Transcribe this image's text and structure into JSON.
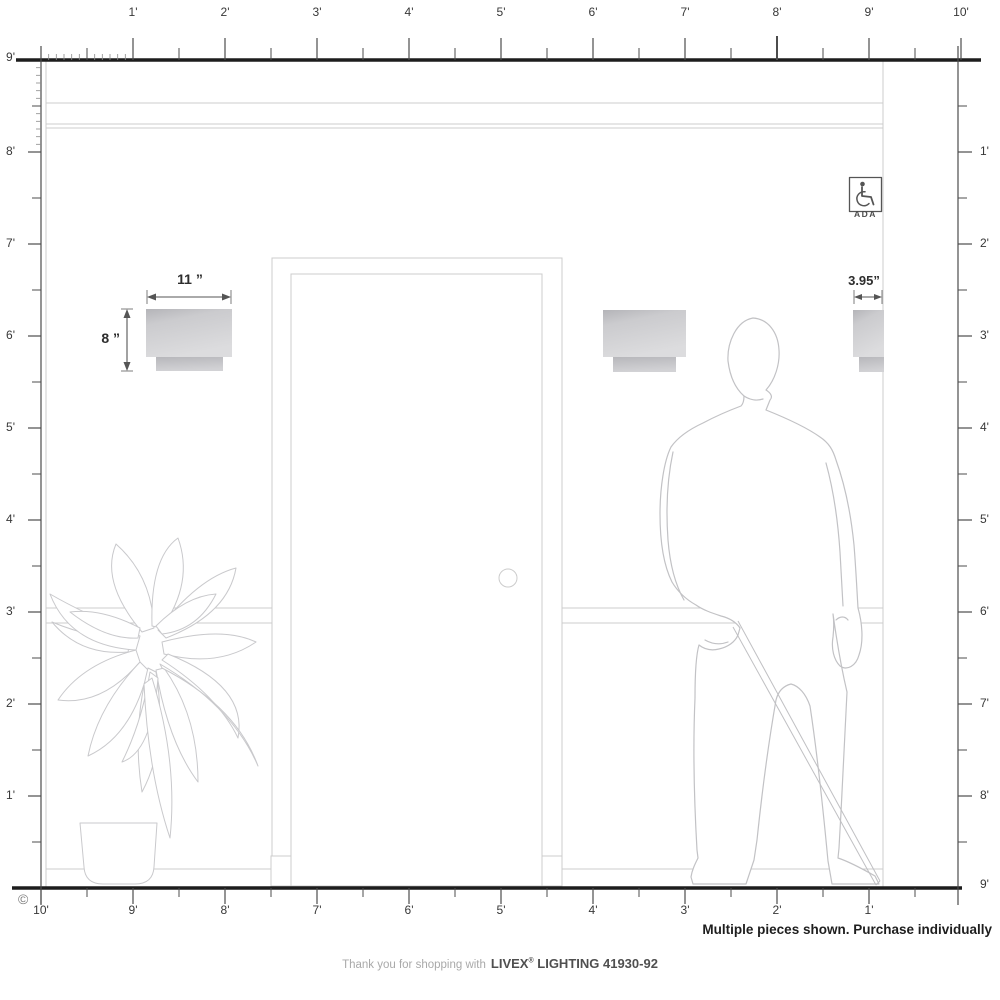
{
  "rulers": {
    "top": [
      "1'",
      "2'",
      "3'",
      "4'",
      "5'",
      "6'",
      "7'",
      "8'",
      "9'",
      "10'"
    ],
    "left": [
      "9'",
      "8'",
      "7'",
      "6'",
      "5'",
      "4'",
      "3'",
      "2'",
      "1'"
    ],
    "right": [
      "1'",
      "2'",
      "3'",
      "4'",
      "5'",
      "6'",
      "7'",
      "8'",
      "9'"
    ],
    "bottom": [
      "10'",
      "9'",
      "8'",
      "7'",
      "6'",
      "5'",
      "4'",
      "3'",
      "2'",
      "1'"
    ]
  },
  "dimensions": {
    "width_label": "11 ”",
    "height_label": "8 ”",
    "depth_label": "3.95”"
  },
  "ada": {
    "label": "ADA"
  },
  "notes": {
    "purchase": "Multiple pieces shown. Purchase individually",
    "copyright": "©"
  },
  "footer": {
    "prefix": "Thank you for shopping with",
    "brand": "LIVEX",
    "registered": "®",
    "rest": " LIGHTING 41930-92"
  },
  "colors": {
    "ruler": "#4c4c4c",
    "heavy_line": "#1d1d1d",
    "wall_line": "#cccccc",
    "figure_line": "#c2c2c5",
    "sconce_dark": "#b4b4b8",
    "sconce_light": "#dcdcde",
    "dimension": "#555555"
  }
}
